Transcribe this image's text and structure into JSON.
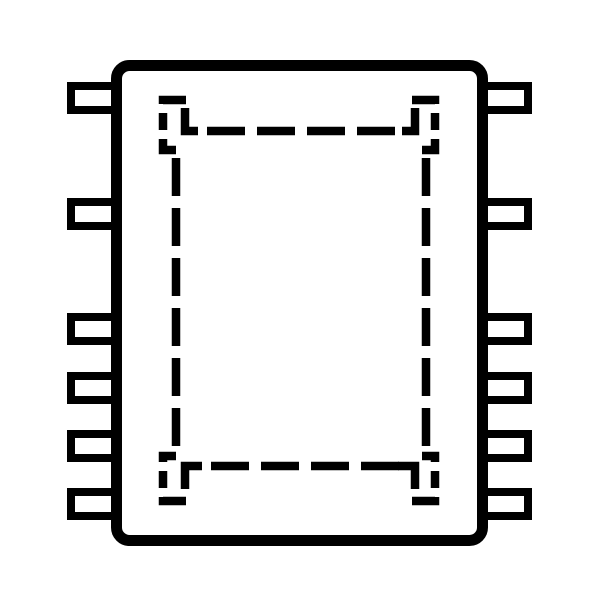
{
  "page": {
    "background": "#ffffff"
  },
  "diagram": {
    "kind": "ic-package-outline-top-view",
    "line_color": "#000000",
    "body_fill": "#ffffff",
    "body": {
      "x": 116.5,
      "y": 65.5,
      "width": 366,
      "height": 475,
      "corner_radius": 13,
      "stroke_width": 11
    },
    "pins": {
      "count_per_side": 6,
      "stroke_width": 8,
      "width": 48,
      "height": 24,
      "left_x": 71,
      "right_x": 480,
      "ys": [
        86,
        202,
        317,
        376,
        434,
        492
      ]
    },
    "pad": {
      "stroke_width": 8.5,
      "edge_dash": "38 12",
      "edges": [
        {
          "name": "pad-edge-top",
          "x1": 207,
          "y1": 131,
          "x2": 402,
          "y2": 131
        },
        {
          "name": "pad-edge-bottom",
          "x1": 211,
          "y1": 466,
          "x2": 402,
          "y2": 466
        },
        {
          "name": "pad-edge-left",
          "x1": 176,
          "y1": 158,
          "x2": 176,
          "y2": 449
        },
        {
          "name": "pad-edge-right",
          "x1": 426,
          "y1": 158,
          "x2": 426,
          "y2": 449
        }
      ],
      "corner_hooks": [
        {
          "name": "pad-hook-top-left",
          "d": "M 185,108 L 185,131 L 198,131"
        },
        {
          "name": "pad-hook-top-right",
          "d": "M 415,108 L 415,131 L 402,131"
        },
        {
          "name": "pad-hook-bottom-left",
          "d": "M 185,489 L 185,466 L 202,466"
        },
        {
          "name": "pad-hook-bottom-right",
          "d": "M 415,489 L 415,466 L 398,466"
        }
      ],
      "bracket_dash": "27 9 17 9 99",
      "brackets": [
        {
          "name": "pad-bracket-top-left",
          "d": "M 186,100 L 163,100 L 163,150 L 176,150"
        },
        {
          "name": "pad-bracket-top-right",
          "d": "M 412,100 L 435,100 L 435,150 L 422,150"
        },
        {
          "name": "pad-bracket-bottom-left",
          "d": "M 186,501 L 163,501 L 163,456 L 176,456"
        },
        {
          "name": "pad-bracket-bottom-right",
          "d": "M 412,501 L 435,501 L 435,456 L 422,456"
        }
      ]
    }
  }
}
